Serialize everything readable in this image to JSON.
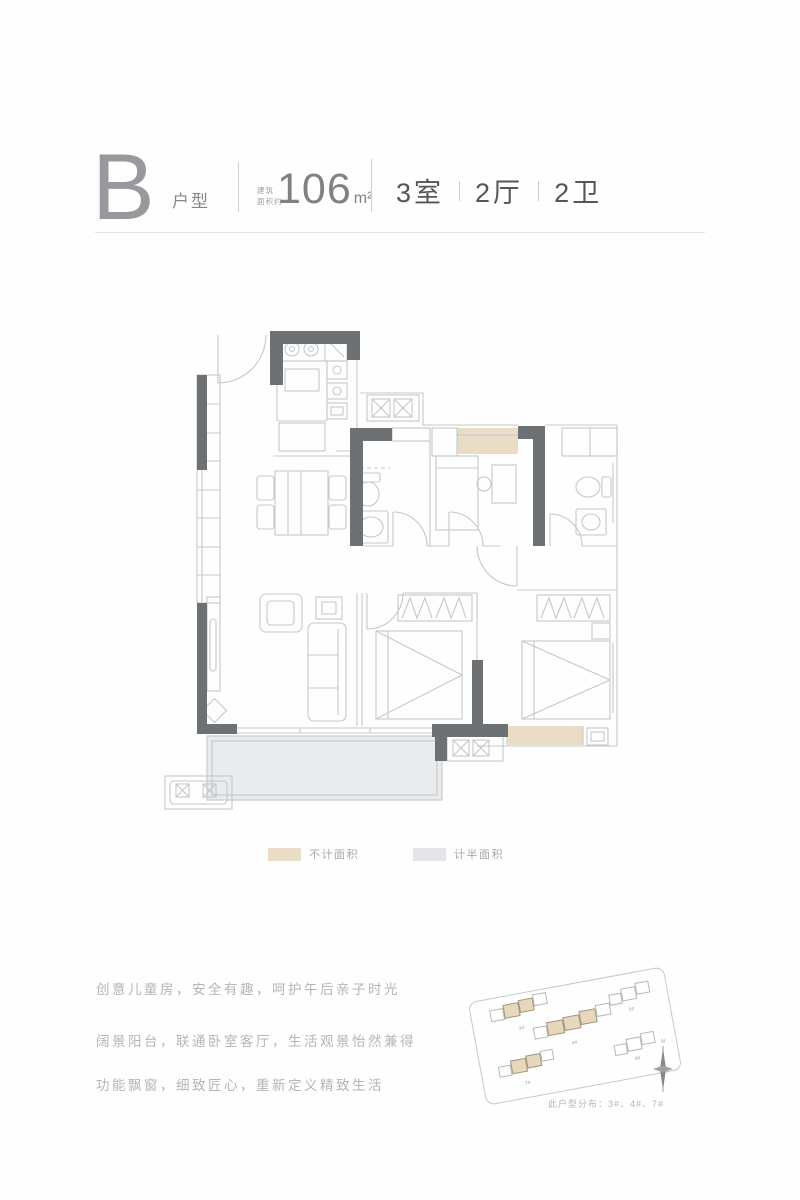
{
  "header": {
    "type_letter": "B",
    "type_label": "户型",
    "area_prefix_line1": "建筑",
    "area_prefix_line2": "面积约",
    "area_value": "106",
    "area_unit": "m²",
    "rooms": [
      "3室",
      "2厅",
      "2卫"
    ]
  },
  "legend": {
    "items": [
      {
        "label": "不计面积",
        "color": "#e9ddc6"
      },
      {
        "label": "计半面积",
        "color": "#e3e5e8"
      }
    ]
  },
  "description_lines": [
    "创意儿童房，安全有趣，呵护午后亲子时光",
    "阔景阳台，联通卧室客厅，生活观景怡然兼得",
    "功能飘窗，细致匠心，重新定义精致生活"
  ],
  "siteplan": {
    "buildings": [
      {
        "label": "3#",
        "highlighted": true
      },
      {
        "label": "4#",
        "highlighted": true
      },
      {
        "label": "7#",
        "highlighted": true
      },
      {
        "label": "5#",
        "highlighted": false
      },
      {
        "label": "6#",
        "highlighted": false
      }
    ],
    "north_mark": "N",
    "caption": "此户型分布：3#、4#、7#"
  },
  "colors": {
    "wall": "#6e7174",
    "plan_line": "#c4c8cc",
    "bay_window_fill": "#e9ddc6",
    "half_area_fill": "#e9ebed",
    "text_light": "#b3b6b9",
    "text_dark": "#54575a"
  }
}
